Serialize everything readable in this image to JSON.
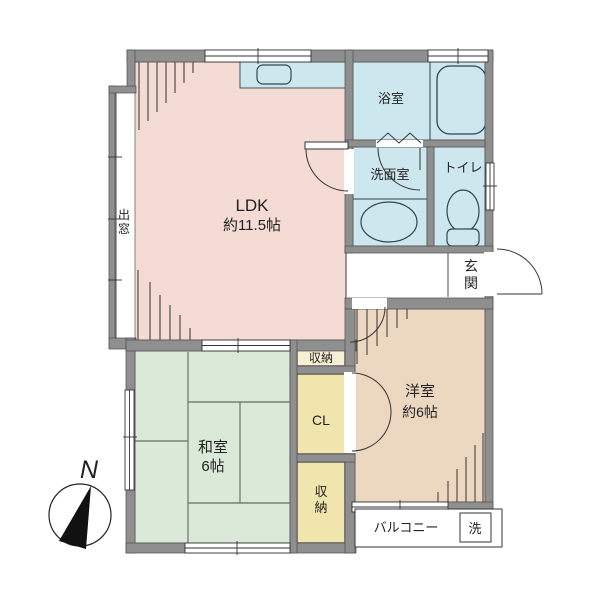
{
  "title": "apartment-floor-plan",
  "colors": {
    "wall": "#8f8f8f",
    "wall_edge": "#4d4d4d",
    "ldk": "#f4dbd3",
    "water": "#cde7ee",
    "tatami": "#dbead8",
    "western": "#ecd8c1",
    "closet": "#f1e5ae",
    "closet_light": "#f7f0d5",
    "line": "#333333",
    "white": "#ffffff"
  },
  "rooms": {
    "ldk": {
      "name": "LDK",
      "size": "約11.5帖"
    },
    "bath": {
      "name": "浴室"
    },
    "washroom": {
      "name": "洗面室"
    },
    "toilet": {
      "name": "トイレ"
    },
    "entrance": {
      "chars": [
        "玄",
        "関"
      ]
    },
    "storage_top": {
      "name": "収納"
    },
    "closet": {
      "name": "CL"
    },
    "storage_bottom": {
      "chars": [
        "収",
        "納"
      ]
    },
    "japanese_room": {
      "name": "和室",
      "size": "6帖"
    },
    "western_room": {
      "name": "洋室",
      "size": "約6帖"
    },
    "balcony": {
      "name": "バルコニー"
    },
    "washer": {
      "name": "洗"
    },
    "bay_window": {
      "chars": [
        "出",
        "窓"
      ]
    }
  },
  "compass": {
    "label": "N"
  }
}
